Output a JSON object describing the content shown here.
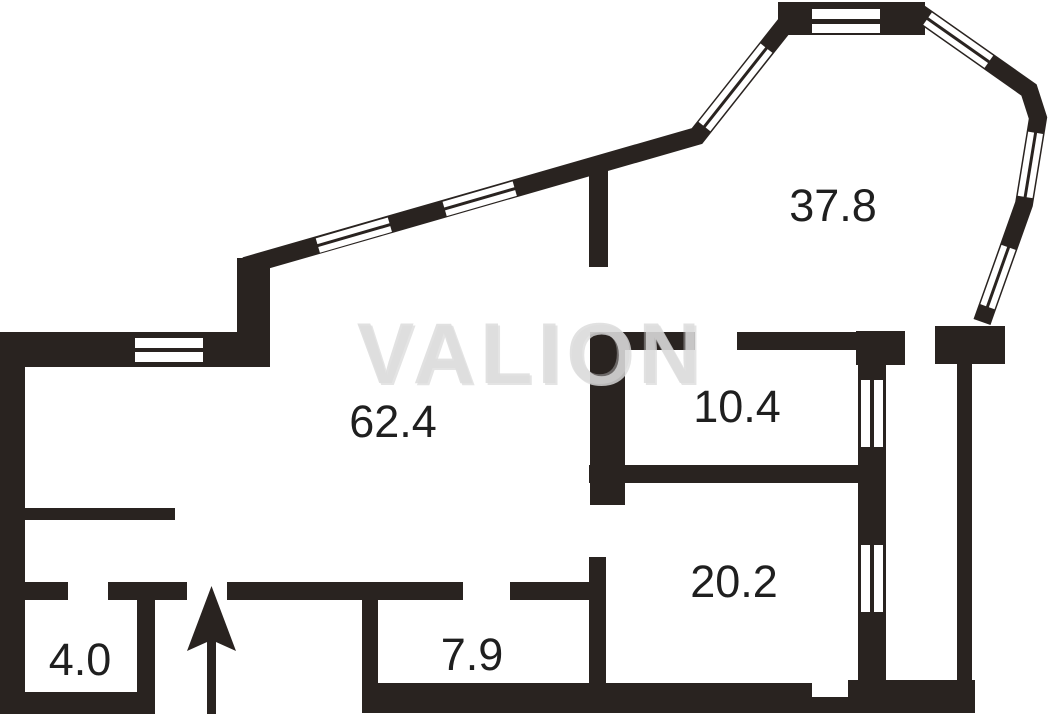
{
  "watermark": "VALION",
  "entrance_arrow_direction": "up",
  "plan": {
    "rooms": [
      {
        "id": "room-1",
        "area": "37.8"
      },
      {
        "id": "room-2",
        "area": "62.4"
      },
      {
        "id": "room-3",
        "area": "10.4"
      },
      {
        "id": "room-4",
        "area": "20.2"
      },
      {
        "id": "room-5",
        "area": "7.9"
      },
      {
        "id": "room-6",
        "area": "4.0"
      }
    ]
  },
  "colors": {
    "walls": "#292320",
    "labels": "#1f1f1f",
    "watermark_fill": "#dedede",
    "watermark_shadow": "#bdbdbd",
    "background": "#ffffff"
  }
}
